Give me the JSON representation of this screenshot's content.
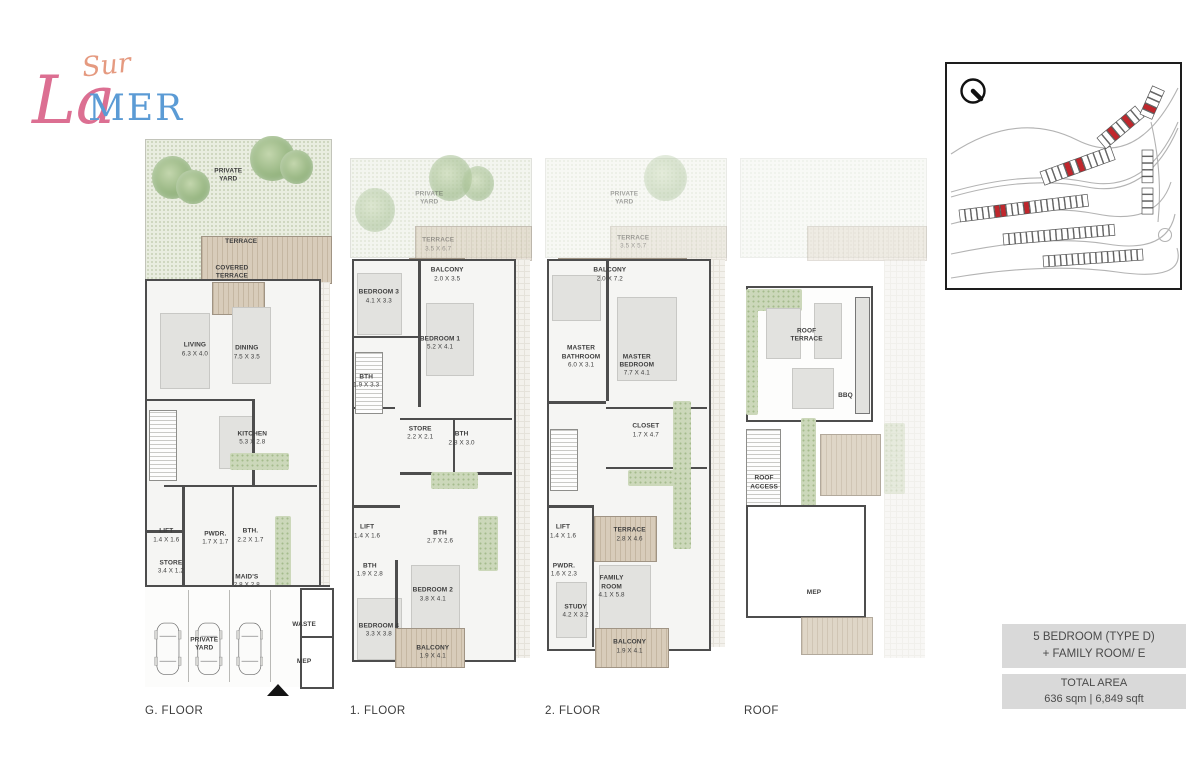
{
  "brand": {
    "sur": "Sur",
    "la": "La",
    "mer": "MER"
  },
  "colors": {
    "accent_red": "#c0272d",
    "wall_gray": "#4d4d4d",
    "yard_green": "#e9ede0",
    "wood_tan": "#cfc2ae",
    "box_gray": "#d9d9d9",
    "logo_pink": "#dc6f92",
    "logo_blue": "#5b9bd5"
  },
  "floors": [
    {
      "label": "G. FLOOR",
      "rooms": [
        {
          "label": "PRIVATE\nYARD",
          "dims": "",
          "x": 45,
          "y": 8
        },
        {
          "label": "TERRACE",
          "dims": "",
          "x": 52,
          "y": 19.5
        },
        {
          "label": "COVERED\nTERRACE",
          "dims": "",
          "x": 47,
          "y": 25
        },
        {
          "label": "LIVING",
          "dims": "6.3 X 4.0",
          "x": 27,
          "y": 38.5
        },
        {
          "label": "DINING",
          "dims": "7.5 X 3.5",
          "x": 55,
          "y": 39
        },
        {
          "label": "KITCHEN",
          "dims": "5.3 X 2.8",
          "x": 58,
          "y": 54
        },
        {
          "label": "LIFT",
          "dims": "1.4 X 1.6",
          "x": 11.5,
          "y": 71
        },
        {
          "label": "STORE",
          "dims": "3.4 X 1.2",
          "x": 14,
          "y": 76.5
        },
        {
          "label": "PWDR.",
          "dims": "1.7 X 1.7",
          "x": 38,
          "y": 71.5
        },
        {
          "label": "BTH.",
          "dims": "2.2 X 1.7",
          "x": 57,
          "y": 71
        },
        {
          "label": "MAID'S",
          "dims": "2.8 X 2.8",
          "x": 55,
          "y": 79
        },
        {
          "label": "WASTE",
          "dims": "",
          "x": 86,
          "y": 86.5
        },
        {
          "label": "MEP",
          "dims": "",
          "x": 86,
          "y": 93
        },
        {
          "label": "PRIVATE\nYARD",
          "dims": "",
          "x": 32,
          "y": 90
        }
      ]
    },
    {
      "label": "1. FLOOR",
      "rooms": [
        {
          "label": "PRIVATE\nYARD",
          "dims": "",
          "x": 44,
          "y": 8,
          "muted": true
        },
        {
          "label": "TERRACE",
          "dims": "3.5 X 6.7",
          "x": 49,
          "y": 16.5,
          "muted": true
        },
        {
          "label": "BALCONY",
          "dims": "2.0 X 3.5",
          "x": 54,
          "y": 22
        },
        {
          "label": "BEDROOM 3",
          "dims": "4.1 X 3.3",
          "x": 16,
          "y": 26
        },
        {
          "label": "BEDROOM 1",
          "dims": "5.2 X 4.1",
          "x": 50,
          "y": 34.5
        },
        {
          "label": "BTH",
          "dims": "1.9 X 3.3",
          "x": 9,
          "y": 41.5
        },
        {
          "label": "STORE",
          "dims": "2.2 X 2.1",
          "x": 39,
          "y": 51
        },
        {
          "label": "BTH",
          "dims": "2.8 X 3.0",
          "x": 62,
          "y": 52
        },
        {
          "label": "LIFT",
          "dims": "1.4 X 1.6",
          "x": 9.5,
          "y": 69
        },
        {
          "label": "BTH",
          "dims": "2.7 X 2.6",
          "x": 50,
          "y": 70
        },
        {
          "label": "BTH",
          "dims": "1.9 X 2.8",
          "x": 11,
          "y": 76
        },
        {
          "label": "BEDROOM 2",
          "dims": "3.8 X 4.1",
          "x": 46,
          "y": 80.5
        },
        {
          "label": "BEDROOM 4",
          "dims": "3.3 X 3.8",
          "x": 16,
          "y": 87
        },
        {
          "label": "BALCONY",
          "dims": "1.9 X 4.1",
          "x": 46,
          "y": 91
        }
      ]
    },
    {
      "label": "2. FLOOR",
      "rooms": [
        {
          "label": "PRIVATE\nYARD",
          "dims": "",
          "x": 44,
          "y": 8,
          "muted": true
        },
        {
          "label": "TERRACE",
          "dims": "3.5 X 5.7",
          "x": 49,
          "y": 16,
          "muted": true
        },
        {
          "label": "BALCONY",
          "dims": "2.0 X 7.2",
          "x": 36,
          "y": 22
        },
        {
          "label": "MASTER\nBATHROOM",
          "dims": "6.0 X 3.1",
          "x": 20,
          "y": 37
        },
        {
          "label": "MASTER\nBEDROOM",
          "dims": "7.7 X 4.1",
          "x": 51,
          "y": 38.5
        },
        {
          "label": "CLOSET",
          "dims": "1.7 X 4.7",
          "x": 56,
          "y": 50.5
        },
        {
          "label": "LIFT",
          "dims": "1.4 X 1.6",
          "x": 10,
          "y": 69
        },
        {
          "label": "TERRACE",
          "dims": "2.8 X 4.6",
          "x": 47,
          "y": 69.5
        },
        {
          "label": "PWDR.",
          "dims": "1.6 X 2.3",
          "x": 10.5,
          "y": 76
        },
        {
          "label": "FAMILY\nROOM",
          "dims": "4.1 X 5.8",
          "x": 37,
          "y": 79
        },
        {
          "label": "STUDY",
          "dims": "4.2 X 3.2",
          "x": 17,
          "y": 83.5
        },
        {
          "label": "BALCONY",
          "dims": "1.9 X 4.1",
          "x": 47,
          "y": 90
        }
      ]
    },
    {
      "label": "ROOF",
      "rooms": [
        {
          "label": "ROOF\nTERRACE",
          "dims": "",
          "x": 36,
          "y": 33
        },
        {
          "label": "BBQ",
          "dims": "",
          "x": 57,
          "y": 44
        },
        {
          "label": "ROOF\nACCESS",
          "dims": "",
          "x": 13,
          "y": 60
        },
        {
          "label": "MEP",
          "dims": "",
          "x": 40,
          "y": 80
        }
      ]
    }
  ],
  "info": {
    "type_line1": "5 BEDROOM (TYPE D)",
    "type_line2": "+ FAMILY ROOM/ E",
    "area_title": "TOTAL AREA",
    "area_value": "636 sqm | 6,849 sqft"
  }
}
